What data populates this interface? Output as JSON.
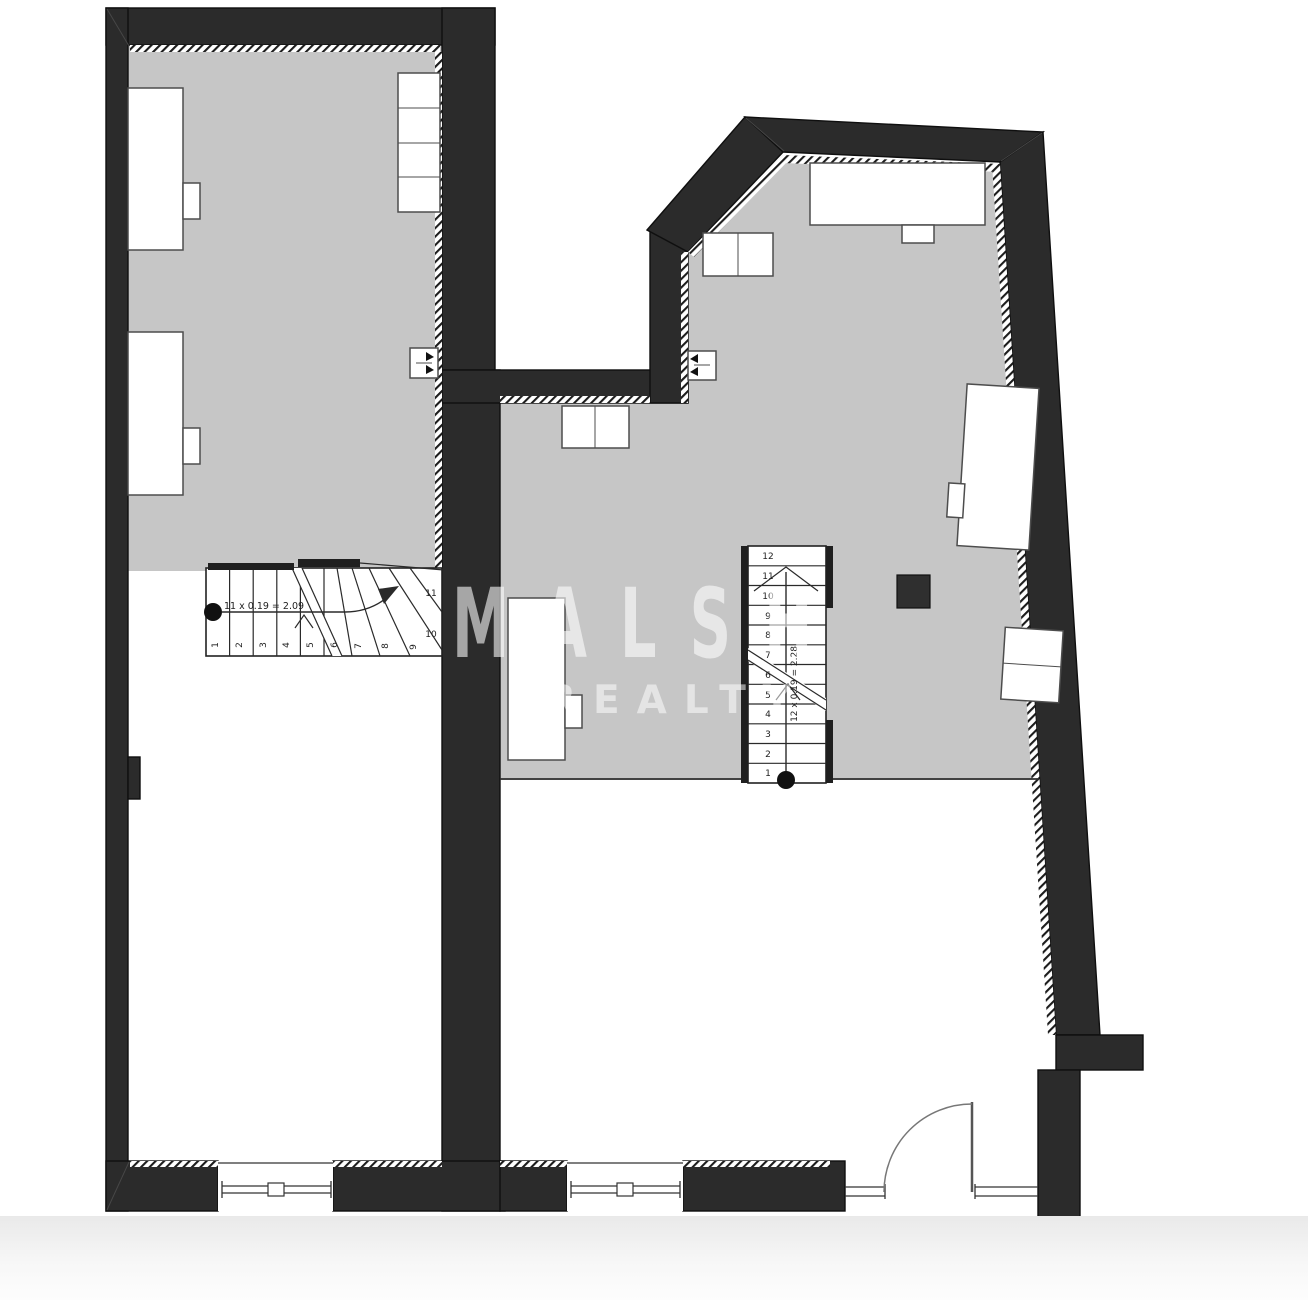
{
  "watermark": {
    "brand": "MALSH",
    "sub": "REALTY"
  },
  "left_unit": {
    "stair": {
      "annotation": "11 x 0.19 = 2.09",
      "step_numbers": [
        "1",
        "2",
        "3",
        "4",
        "5",
        "6",
        "7",
        "8",
        "9"
      ],
      "winder_numbers": [
        "10",
        "11"
      ]
    }
  },
  "right_unit": {
    "stair": {
      "annotation": "12 x 0.19 = 2.28",
      "step_numbers": [
        "1",
        "2",
        "3",
        "4",
        "5",
        "6",
        "7",
        "8",
        "9",
        "10",
        "11",
        "12"
      ]
    }
  },
  "colors": {
    "wall": "#2b2b2b",
    "floor": "#c6c6c6",
    "furniture_outline": "#4d4d4d",
    "watermark": "rgba(255,255,255,0.58)",
    "background": "#ffffff"
  }
}
